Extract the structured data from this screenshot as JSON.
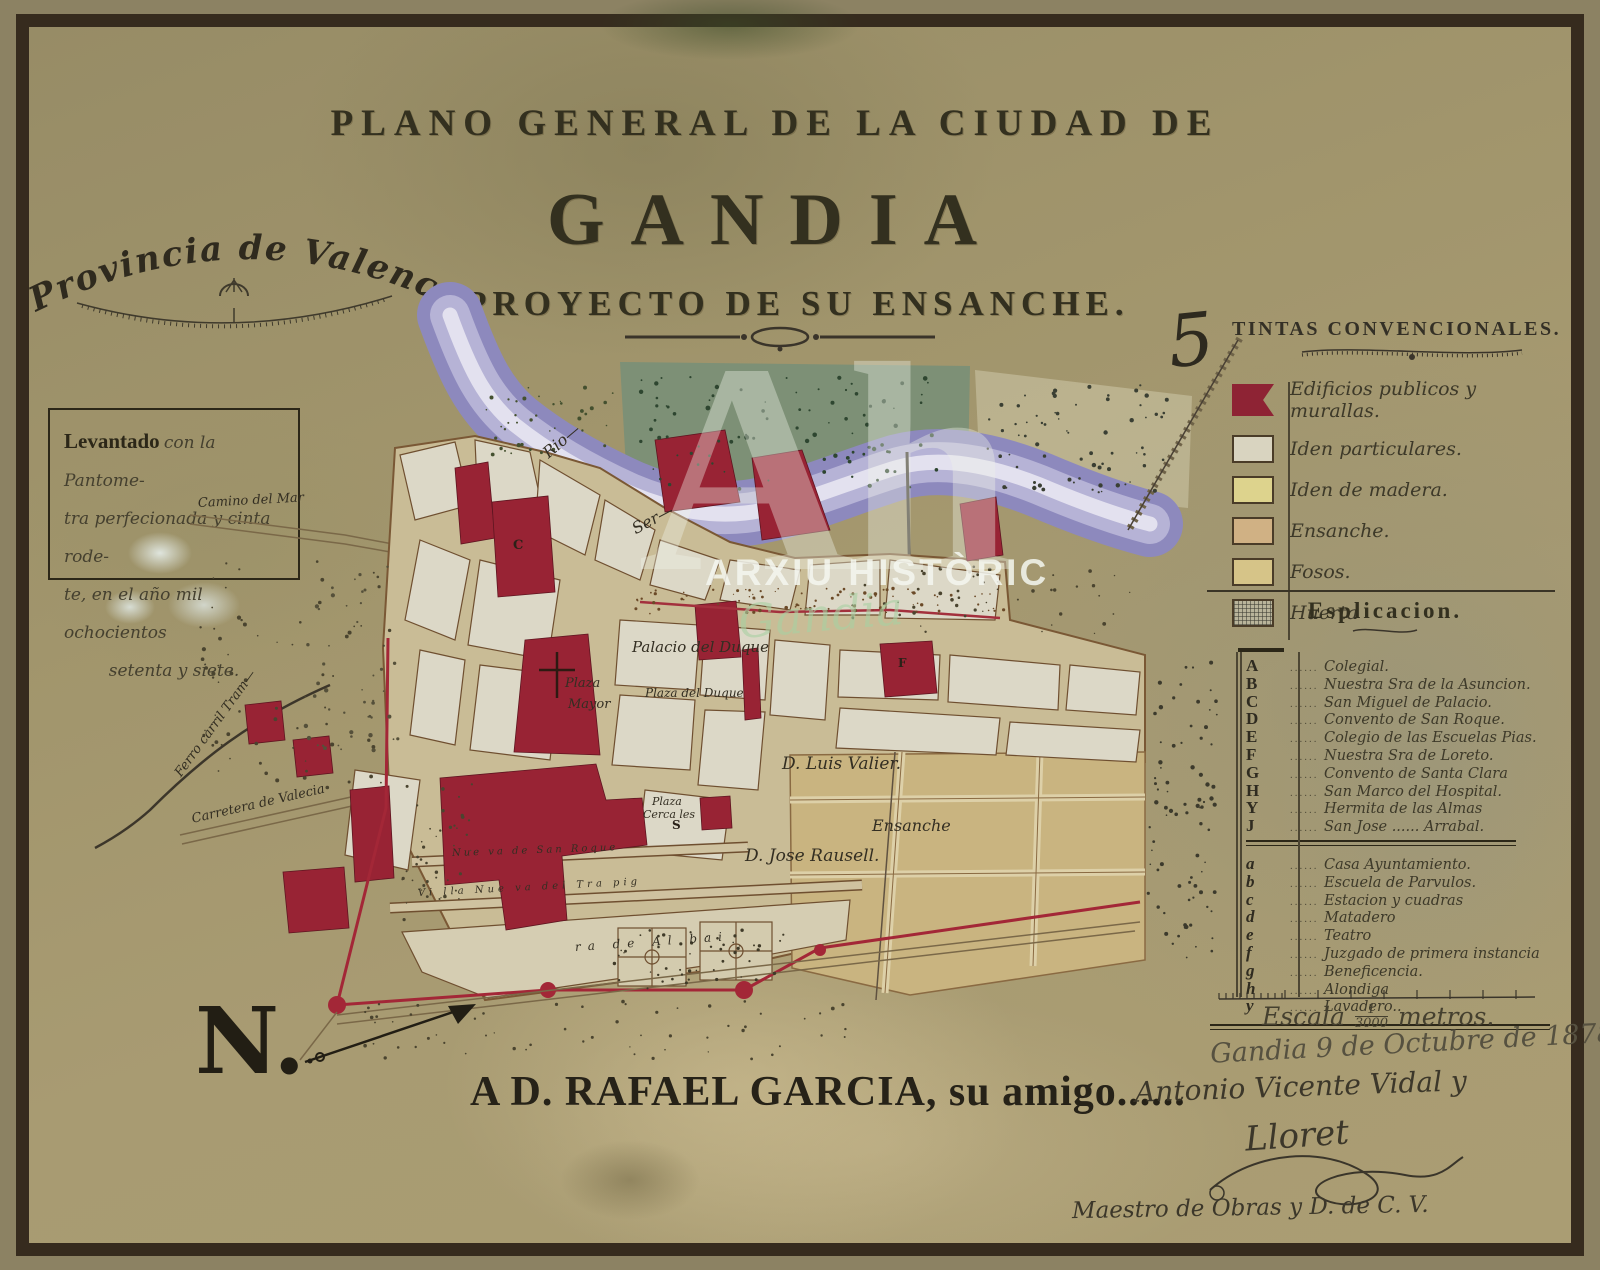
{
  "title": {
    "line1": "PLANO GENERAL DE LA CIUDAD DE",
    "line2": "GANDIA",
    "line3": "Y PROYECTO DE SU ENSANCHE."
  },
  "province_label": "Provincia de Valencia.",
  "survey_note": {
    "lead": "Levantado",
    "line1": "con la Pantome-",
    "line2": "tra perfecionada y cinta rode-",
    "line3": "te, en el año mil ochocientos",
    "line4": "setenta y siete."
  },
  "legend": {
    "ornament": "5",
    "title": "TINTAS CONVENCIONALES.",
    "items": [
      {
        "label": "Edificios publicos y murallas.",
        "color": "#8e2334"
      },
      {
        "label": "Iden particulares.",
        "color": "#d9d4c0"
      },
      {
        "label": "Iden de madera.",
        "color": "#ddd38d"
      },
      {
        "label": "Ensanche.",
        "color": "#d0b184"
      },
      {
        "label": "Fosos.",
        "color": "#d6c488"
      },
      {
        "label": "Huerta",
        "color": "#9aa08e"
      }
    ]
  },
  "explanation": {
    "title": "Esplicacion.",
    "upper": [
      {
        "key": "A",
        "label": "Colegial."
      },
      {
        "key": "B",
        "label": "Nuestra Sra de la Asuncion."
      },
      {
        "key": "C",
        "label": "San Miguel de Palacio."
      },
      {
        "key": "D",
        "label": "Convento de San Roque."
      },
      {
        "key": "E",
        "label": "Colegio de las Escuelas Pias."
      },
      {
        "key": "F",
        "label": "Nuestra Sra de Loreto."
      },
      {
        "key": "G",
        "label": "Convento de Santa Clara"
      },
      {
        "key": "H",
        "label": "San Marco del Hospital."
      },
      {
        "key": "Y",
        "label": "Hermita de las Almas"
      },
      {
        "key": "J",
        "label": "San Jose ...... Arrabal."
      }
    ],
    "lower": [
      {
        "key": "a",
        "label": "Casa Ayuntamiento."
      },
      {
        "key": "b",
        "label": "Escuela de Parvulos."
      },
      {
        "key": "c",
        "label": "Estacion y cuadras"
      },
      {
        "key": "d",
        "label": "Matadero"
      },
      {
        "key": "e",
        "label": "Teatro"
      },
      {
        "key": "f",
        "label": "Juzgado de primera instancia"
      },
      {
        "key": "g",
        "label": "Beneficencia."
      },
      {
        "key": "h",
        "label": "Alondiga"
      },
      {
        "key": "y",
        "label": "Lavadero.."
      }
    ]
  },
  "scale": {
    "label": "Escala",
    "fraction_top": "1",
    "fraction_bottom": "3000",
    "unit": "metros."
  },
  "date_line": "Gandia 9 de Octubre de 1878.",
  "dedication": {
    "printed": "A D. RAFAEL GARCIA, su amigo......",
    "signature_line1": "Antonio Vicente Vidal y",
    "signature_line2": "Lloret",
    "credit": "Maestro de Obras y D. de C. V."
  },
  "compass_letter": "N.",
  "watermark": {
    "big": "Ah",
    "line": "ARXIU HISTÒRIC",
    "script": "Gandia"
  },
  "map_labels": {
    "rio": "Rio—",
    "ser": "Ser—",
    "palacio": "Palacio del Duque",
    "plaza1": "Plaza",
    "plaza2": "Mayor",
    "plaza_duque": "Plaza del Duque",
    "luis_valier": "D. Luis Valier.",
    "ensanche": "Ensanche",
    "jose_rausell": "D. Jose Rausell.",
    "cerca1": "Plaza",
    "cerca2": "Cerca les",
    "camino_mar": "Camino del Mar",
    "carretera": "Carretera de Valecia",
    "ferrocarril": "Ferro carril Tram—",
    "calle_nueva": "Nue va de San Roque",
    "villanueva": "Vi lla Nue va del Tra pig",
    "via_al": "ra   de Al   bai",
    "letter_c": "C",
    "letter_s": "S",
    "letter_f": "F"
  }
}
